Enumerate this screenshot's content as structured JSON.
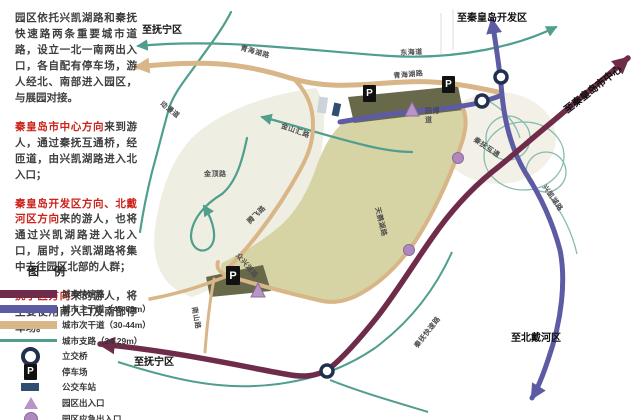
{
  "intro": "园区依托兴凯湖路和秦抚快速路两条重要城市道路，设立一北一南两出入口，各自配有停车场，游人经北、南部进入园区，与展园对接。",
  "paragraphs": [
    {
      "highlight": "秦皇岛市中心方向",
      "rest": "来到游人，通过秦抚互通桥，经匝道，由兴凯湖路进入北入口；"
    },
    {
      "highlight": "秦皇岛开发区方向、北戴河区方向",
      "rest": "来的游人，也将通过兴凯湖路进入北入口，届时，兴凯湖路将集中去往园区北部的人群；"
    },
    {
      "highlight": "抚宁区方向",
      "rest": "来的游人，将主要使用南入口及南部停车场。"
    }
  ],
  "legend": {
    "title": "图 例",
    "items": [
      {
        "label": "城市快速路"
      },
      {
        "label": "城市主干道（45-60m）"
      },
      {
        "label": "城市次干道（30-44m）"
      },
      {
        "label": "城市支路（24-29m）"
      },
      {
        "label": "立交桥"
      },
      {
        "label": "停车场"
      },
      {
        "label": "公交车站"
      },
      {
        "label": "园区出入口"
      },
      {
        "label": "园区应急出入口"
      }
    ]
  },
  "colors": {
    "expressway": "#6e2c4a",
    "arterial": "#5c5ba3",
    "secondary": "#d9b687",
    "branch": "#4f9e8e",
    "park_fill": "#d6d3a4",
    "parking_lot": "#68684a",
    "entrance_marker": "#b795c6",
    "highlight_text": "#cb2219"
  },
  "destinations": {
    "funing_top": "至抚宁区",
    "kaifaqu": "至秦皇岛开发区",
    "city_center": "至秦皇岛市中心",
    "beidaihe": "至北戴河区",
    "funing_bottom": "至抚宁区"
  },
  "road_labels": {
    "donghai": "东海道",
    "qinghaihu_w": "青海湖路",
    "qinghaihu_n": "青海湖路",
    "dongman": "动漫道",
    "jinding": "金顶路",
    "jinshanhui": "金山汇路",
    "tengfei": "腾飞路",
    "yuanbo": "园博道",
    "xingkaihu": "兴凯湖路",
    "qinfu_hutong": "秦抚互通",
    "tianehu": "天鹅湖路",
    "zhongxinghu": "众兴湖路",
    "nanshan": "南山路",
    "qinfu_expwy": "秦抚快速路"
  },
  "markers": {
    "parking": "P"
  }
}
